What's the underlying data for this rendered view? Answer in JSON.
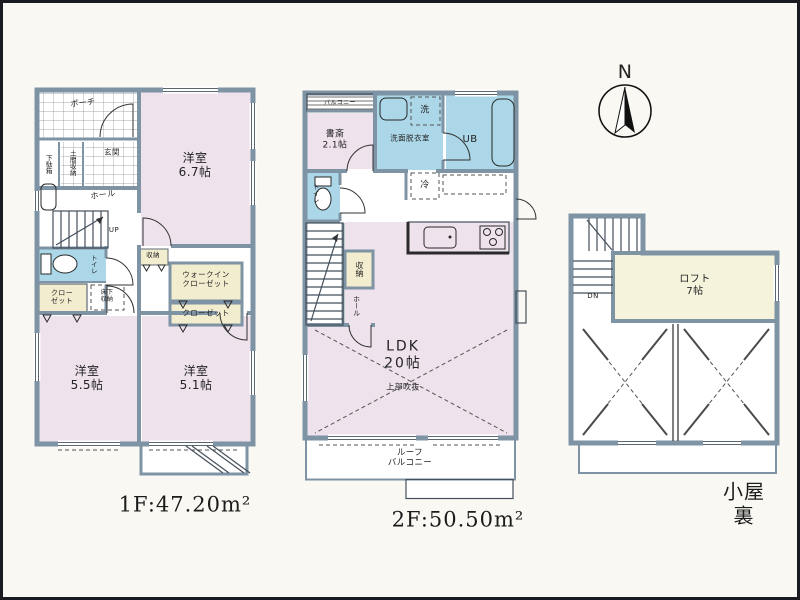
{
  "colors": {
    "wall": "#7e93a4",
    "room_pink": "#eee2ed",
    "wet_blue": "#abd7e8",
    "closet_cream": "#f2edcf",
    "loft_cream": "#f6f3dc",
    "paper": "#f9f8f3"
  },
  "compass": {
    "north": "N"
  },
  "floor1": {
    "area": "1F:47.20m²",
    "porch": "ポーチ",
    "shoe_cabinet": "下駄箱",
    "doma_storage": "土間収納",
    "entrance": "玄関",
    "hall": "ホール",
    "stairs_up": "UP",
    "toilet": "トイレ",
    "closet_a": "クロー\nゼット",
    "underfloor_storage": "床下\n収納",
    "storage": "収納",
    "walk_in_closet": "ウォークイン\nクローゼット",
    "closet_b": "クローゼット",
    "bedroom_67": "洋室\n6.7帖",
    "bedroom_55": "洋室\n5.5帖",
    "bedroom_51": "洋室\n5.1帖"
  },
  "floor2": {
    "area": "2F:50.50m²",
    "balcony": "バルコニー",
    "study": "書斎\n2.1帖",
    "washroom": "洗面脱衣室",
    "washer": "洗",
    "unit_bath": "UB",
    "toilet": "トイレ",
    "storage": "収納",
    "hall": "ホール",
    "fridge": "冷",
    "ldk": "LDK\n20帖",
    "open_above": "上部吹抜",
    "roof_balcony": "ルーフ\nバルコニー"
  },
  "attic": {
    "area": "小屋裏",
    "down": "DN",
    "loft": "ロフト\n7帖"
  }
}
